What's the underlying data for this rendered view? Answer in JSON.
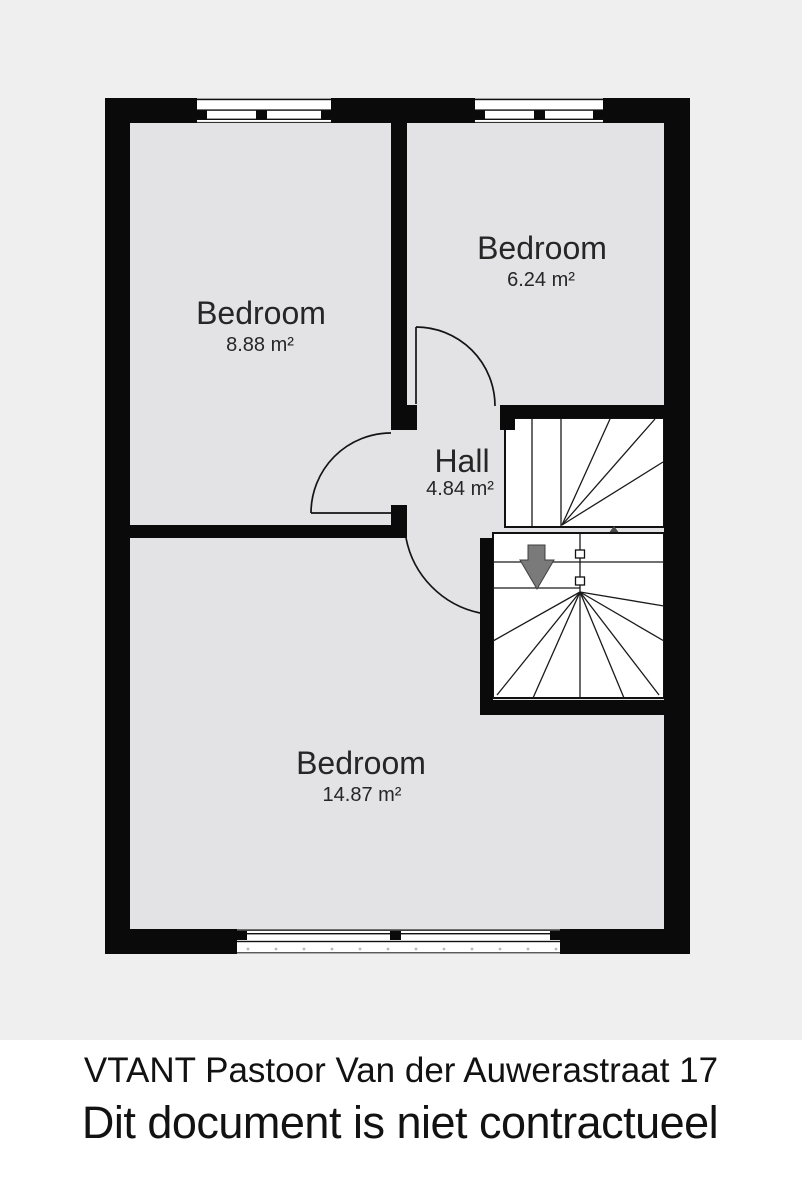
{
  "footer": {
    "line1": "VTANT Pastoor Van der Auwerastraat 17",
    "line2": "Dit document is niet contractueel"
  },
  "rooms": [
    {
      "id": "bedroom-top-left",
      "name": "Bedroom",
      "area": "8.88 m²"
    },
    {
      "id": "bedroom-top-right",
      "name": "Bedroom",
      "area": "6.24 m²"
    },
    {
      "id": "hall",
      "name": "Hall",
      "area": "4.84 m²"
    },
    {
      "id": "bedroom-bottom",
      "name": "Bedroom",
      "area": "14.87 m²"
    }
  ],
  "stairs": {
    "direction": "down",
    "marker": "down-arrow"
  },
  "colors": {
    "page_background": "#f0eff0",
    "floor": "#e3e2e4",
    "wall": "#0a0a0a",
    "stairs_fill": "#ffffff",
    "stair_line": "#1a1a1a",
    "arrow": "#7a7a7a",
    "room_text": "#262626",
    "footer_text": "#121212",
    "window_dot": "#b9b8ba"
  }
}
